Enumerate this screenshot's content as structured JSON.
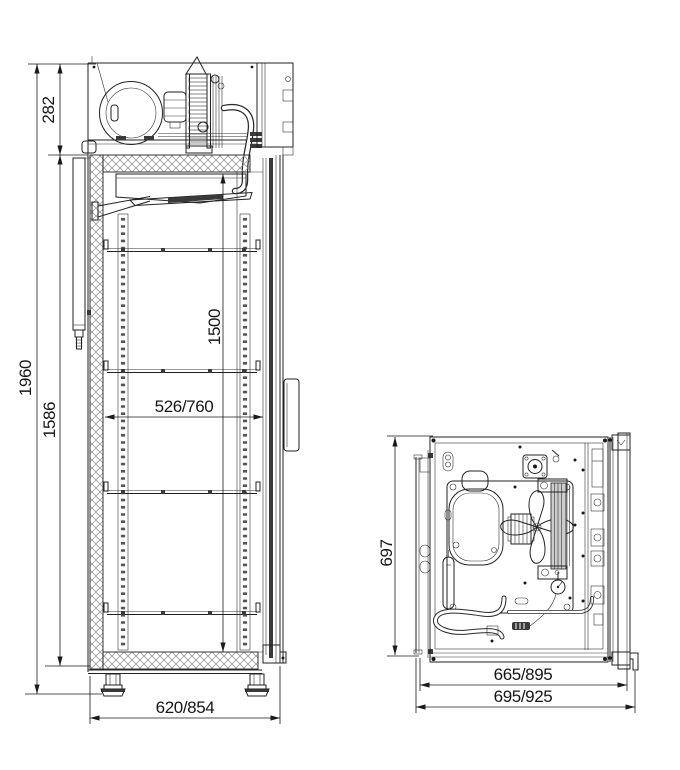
{
  "page": {
    "background": "#ffffff",
    "line_color": "#222222",
    "hatch_color": "#777777"
  },
  "views": {
    "side": {
      "label": "side-section-view",
      "dims": {
        "overall_height": "1960",
        "compartment_height": "282",
        "body_height": "1586",
        "interior_height": "1500",
        "interior_depth": "526/760",
        "overall_depth": "620/854"
      }
    },
    "top": {
      "label": "plan-view",
      "dims": {
        "body_depth": "697",
        "body_width": "665/895",
        "overall_width": "695/925"
      }
    }
  }
}
